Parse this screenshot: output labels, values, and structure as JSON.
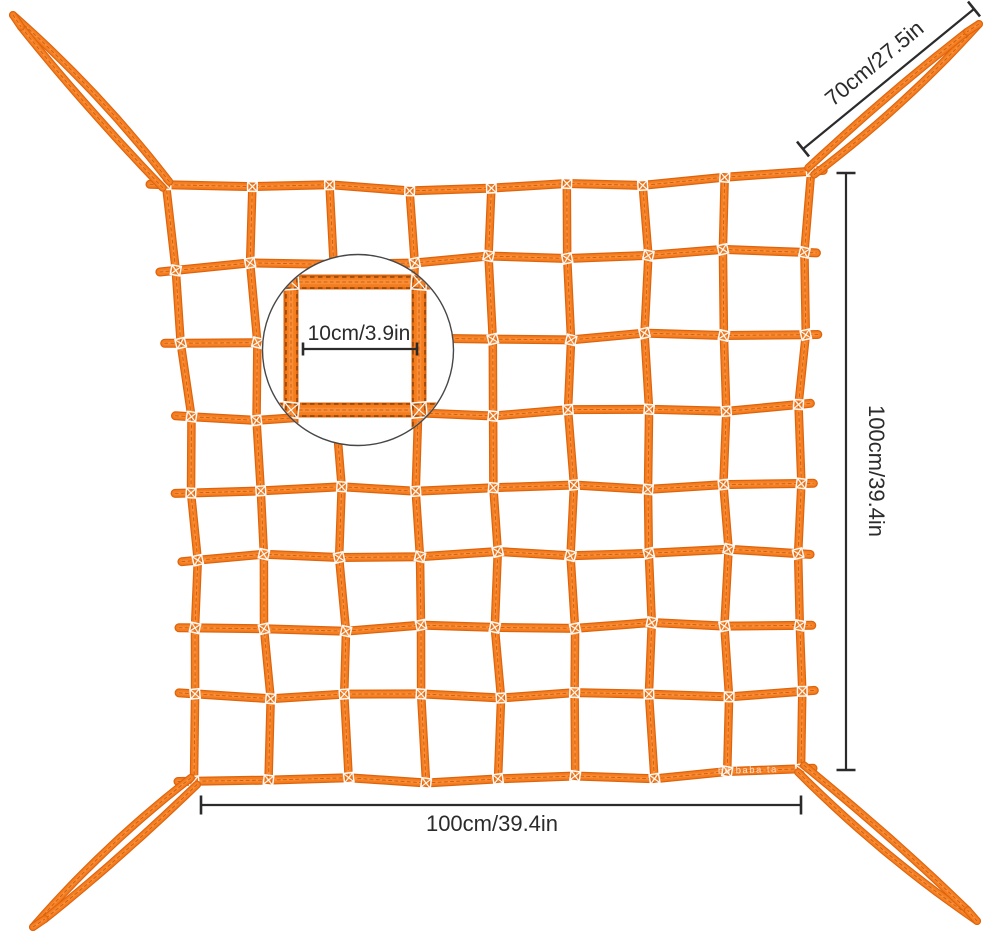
{
  "image": {
    "description": "Orange cargo net with four corner strap loops, magnified mesh detail circle and dimension annotations on a white background",
    "background": "#ffffff"
  },
  "net": {
    "rows": 8,
    "columns": 8,
    "corner_loops": 4
  },
  "annotations": {
    "loop_length": "70cm/27.5in",
    "net_height": "100cm/39.4in",
    "net_width": "100cm/39.4in",
    "mesh_size": "10cm/3.9in"
  },
  "watermark": "bd baba ta",
  "colors": {
    "webbing": "#f57d1e",
    "webbing_edge": "#dc640f",
    "webbing_highlight": "#ff9d52",
    "stitch": "#bf5608",
    "stitch_dark": "#6b3606",
    "dimension": "#2b2b2b",
    "magnifier_border": "#474747",
    "box_mark": "#ffffff"
  }
}
